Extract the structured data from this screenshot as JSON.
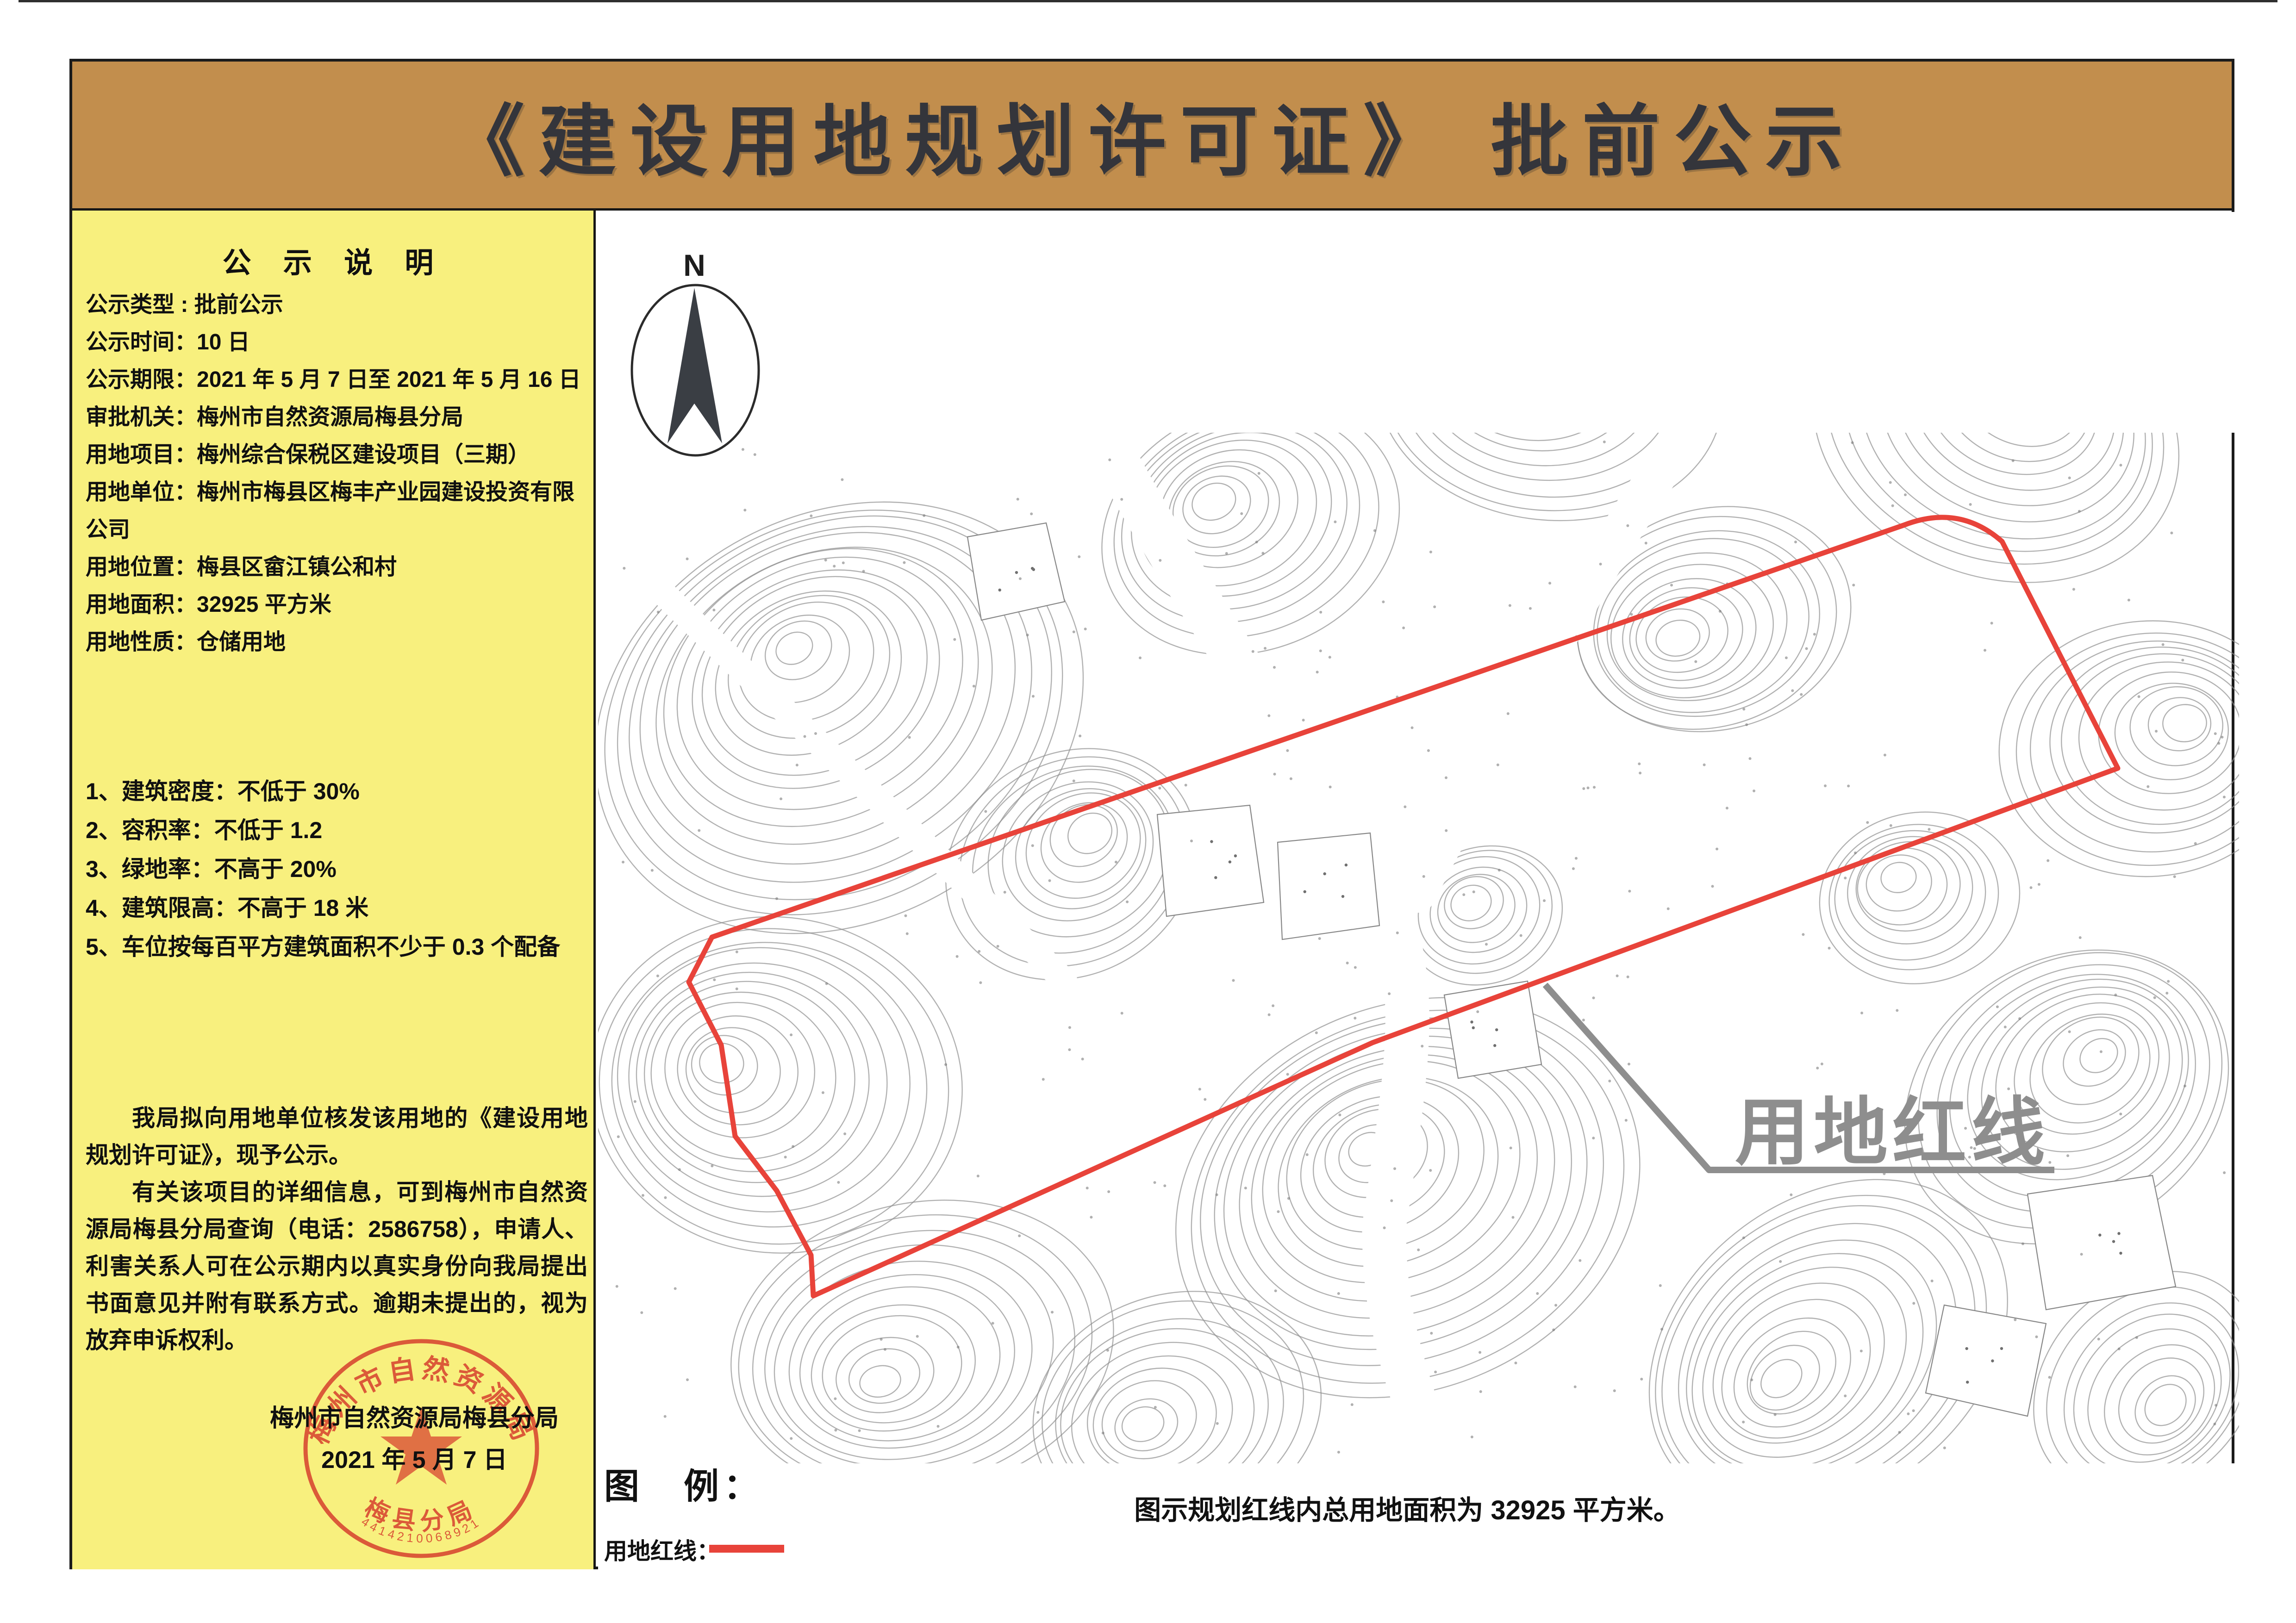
{
  "header": {
    "title": "《建设用地规划许可证》 批前公示"
  },
  "sidebar": {
    "title": "公 示 说 明",
    "info": [
      "公示类型 : 批前公示",
      "公示时间：10 日",
      "公示期限：2021 年 5 月 7 日至 2021 年 5 月 16 日",
      "审批机关：梅州市自然资源局梅县分局",
      "用地项目：梅州综合保税区建设项目（三期）",
      "用地单位：梅州市梅县区梅丰产业园建设投资有限公司",
      "用地位置：梅县区畲江镇公和村",
      "用地面积：32925 平方米",
      "用地性质：仓储用地"
    ],
    "conditions": [
      "1、建筑密度：不低于 30%",
      "2、容积率：不低于 1.2",
      "3、绿地率：不高于 20%",
      "4、建筑限高：不高于 18 米",
      "5、车位按每百平方建筑面积不少于 0.3 个配备"
    ],
    "paragraphs": [
      "我局拟向用地单位核发该用地的《建设用地规划许可证》，现予公示。",
      "有关该项目的详细信息，可到梅州市自然资源局梅县分局查询（电话：2586758），申请人、利害关系人可在公示期内以真实身份向我局提出书面意见并附有联系方式。逾期未提出的，视为放弃申诉权利。"
    ],
    "signature": {
      "agency": "梅州市自然资源局梅县分局",
      "date": "2021 年 5 月 7 日"
    },
    "seal": {
      "arc_top": "梅州市自然资源局",
      "arc_bottom": "梅县分局",
      "serial": "4414210068921"
    }
  },
  "map": {
    "north_label": "N",
    "red_line_label": "用地红线",
    "red_line_path": "M1538,2025 L4112,1135 Q4232,1088 4325,1170 L4575,1660 L2965,2253 L1757,2800 L1752,2712 L1678,2573 L1588,2455 L1558,2258 L1488,2122 Z",
    "leader_path": "M3338,2128 L3692,2528 L4438,2528"
  },
  "legend": {
    "title": "图　例：",
    "item_label": "用地红线：",
    "caption": "图示规划红线内总用地面积为 32925 平方米。"
  },
  "colors": {
    "header_brown": "#c28e4d",
    "panel_yellow": "#f8f07e",
    "red_line": "#e8433a",
    "seal_red": "#d7402e",
    "label_gray": "#8e8e8e",
    "contour_gray": "#909090"
  }
}
